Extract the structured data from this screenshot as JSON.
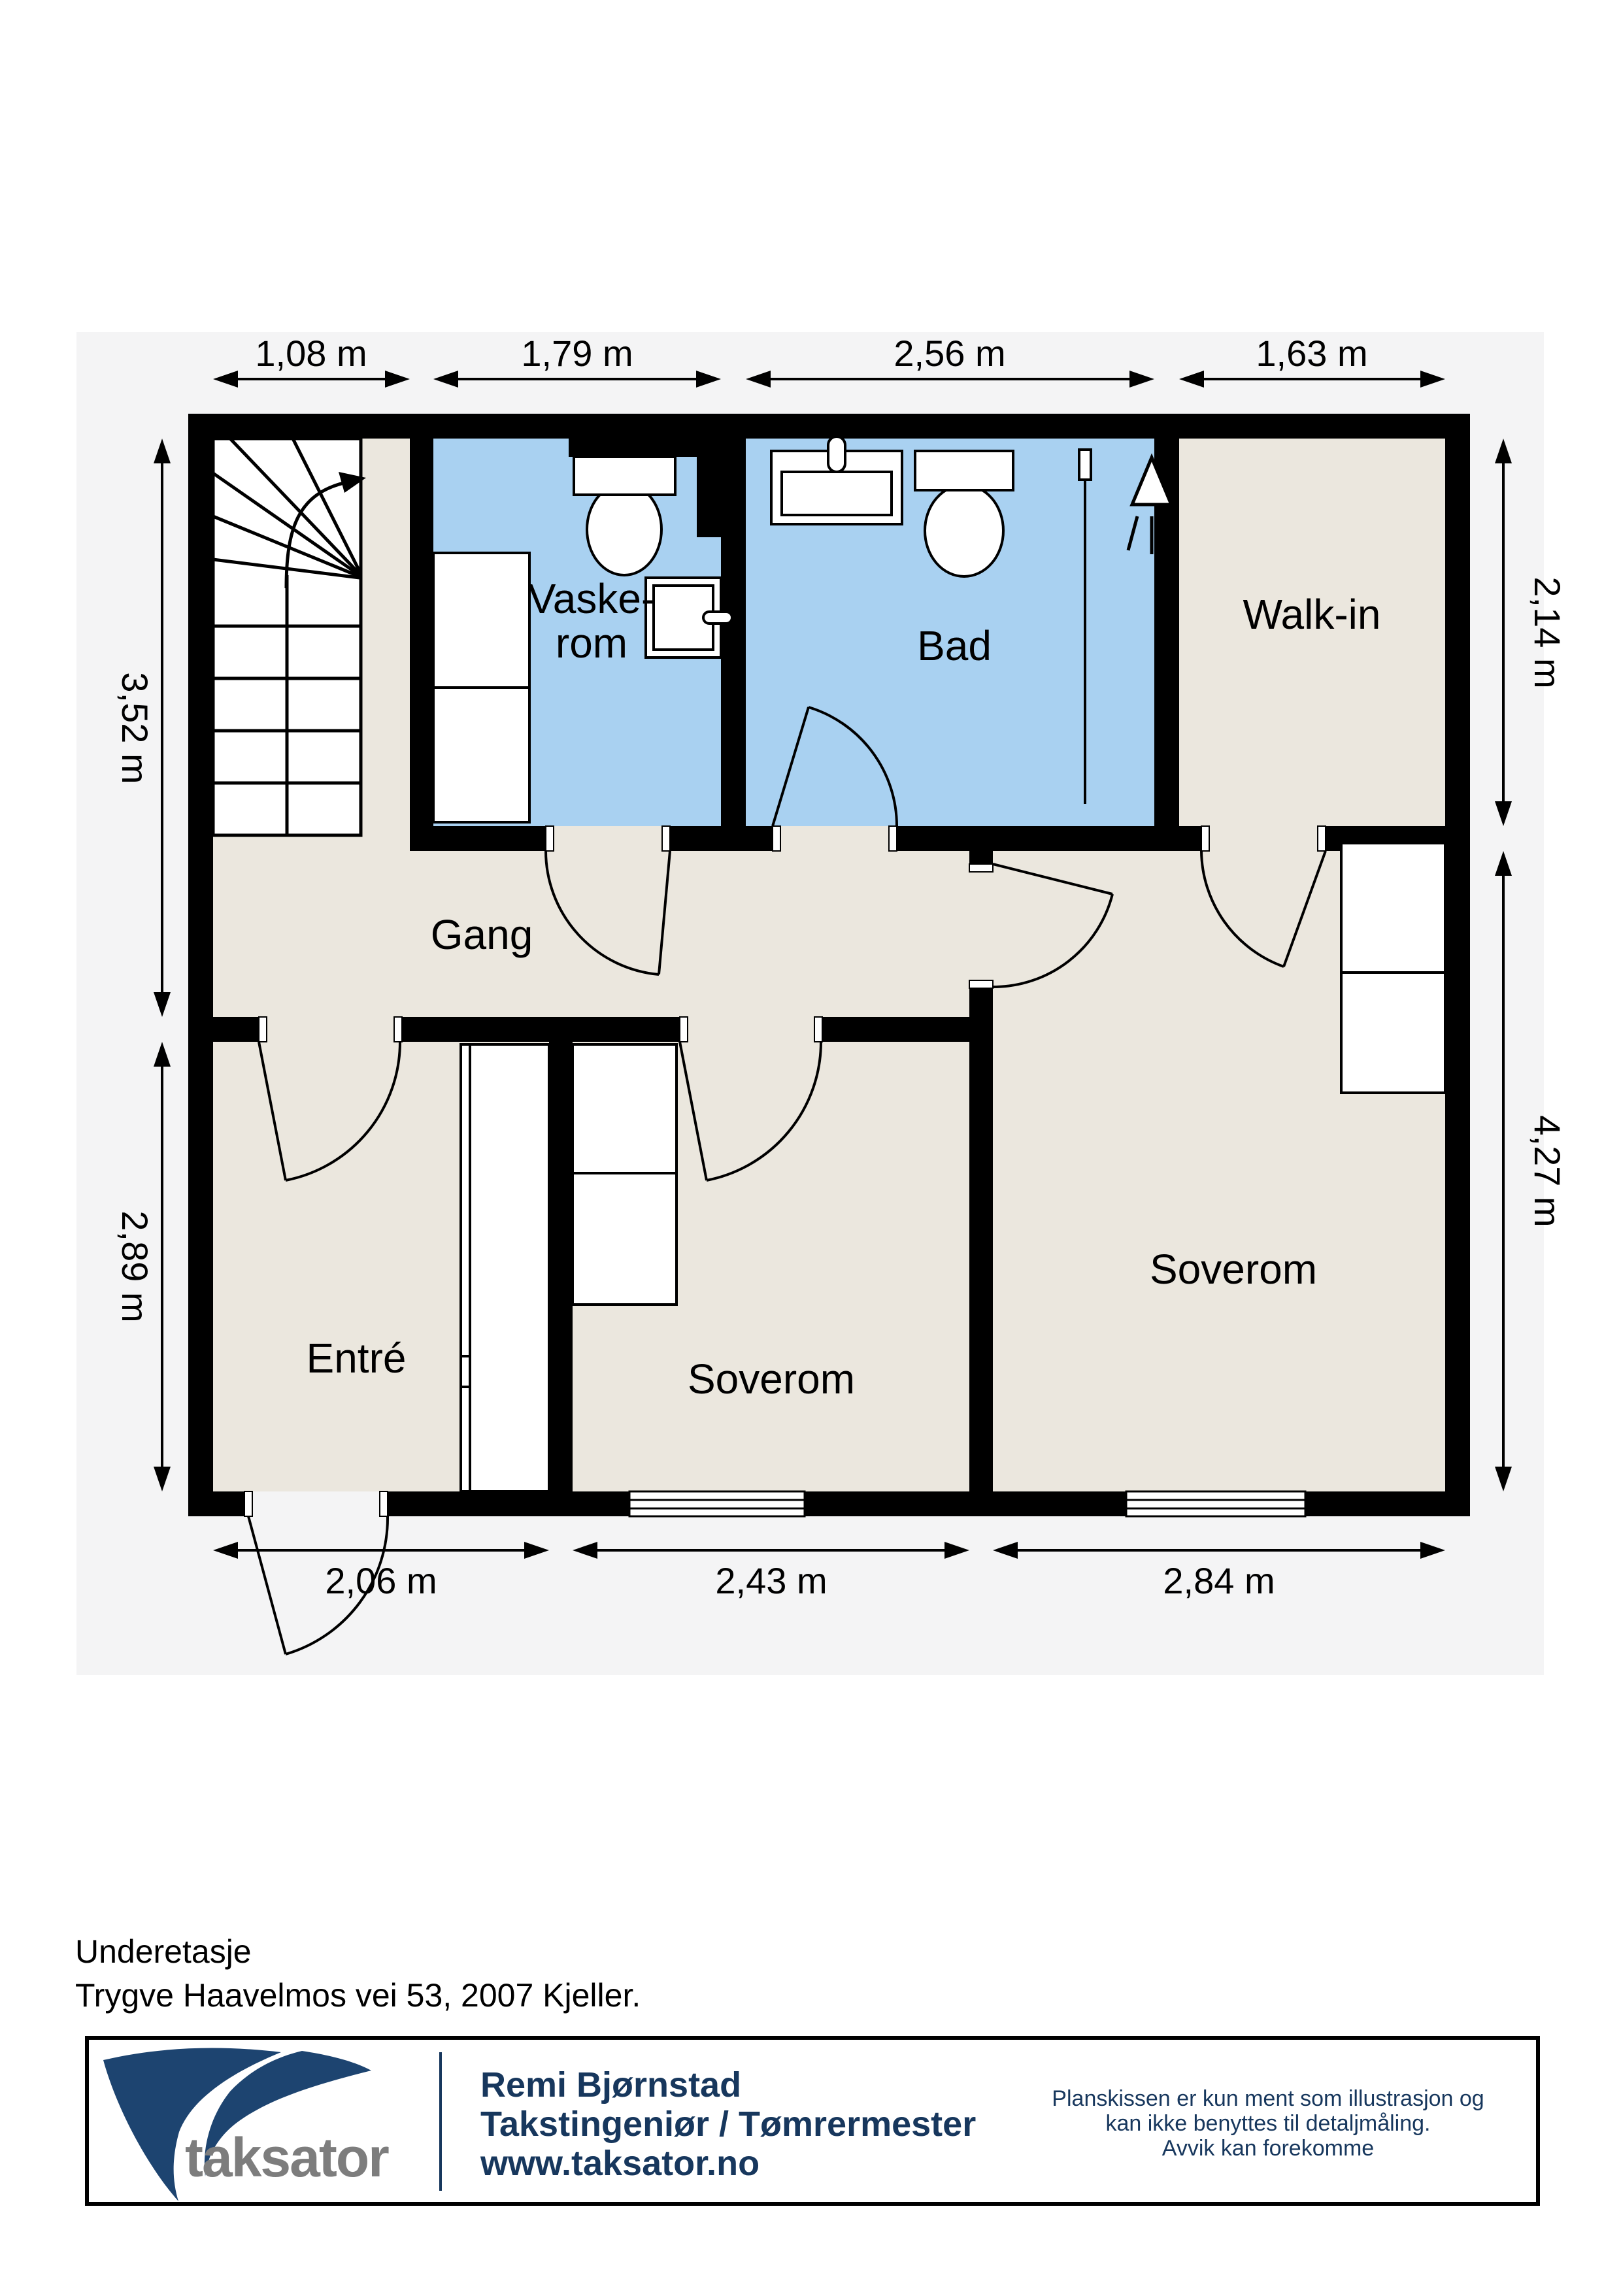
{
  "page": {
    "floor_label": "Underetasje",
    "address": "Trygve Haavelmos vei 53, 2007 Kjeller."
  },
  "plan": {
    "panel_color": "#f4f4f5",
    "floor_color": "#ebe7de",
    "wet_room_color": "#a9d1f1",
    "wall_color": "#000000",
    "rooms": {
      "vaskerom": {
        "line1": "Vaske-",
        "line2": "rom"
      },
      "bad": {
        "label": "Bad"
      },
      "walkin": {
        "label": "Walk-in"
      },
      "gang": {
        "label": "Gang"
      },
      "entre": {
        "label": "Entré"
      },
      "soverom_mid": {
        "label": "Soverom"
      },
      "soverom_right": {
        "label": "Soverom"
      }
    },
    "dimensions": {
      "top": [
        "1,08 m",
        "1,79 m",
        "2,56 m",
        "1,63 m"
      ],
      "left": [
        "3,52 m",
        "2,89 m"
      ],
      "right": [
        "2,14 m",
        "4,27 m"
      ],
      "bottom": [
        "2,06 m",
        "2,43 m",
        "2,84 m"
      ]
    }
  },
  "footer": {
    "logo_text": "taksator",
    "logo_color": "#1d4470",
    "logo_text_color": "#7d7d7d",
    "contact_name": "Remi Bjørnstad",
    "contact_title": "Takstingeniør / Tømrermester",
    "contact_web": "www.taksator.no",
    "disclaimer_line1": "Planskissen er kun ment som illustrasjon og",
    "disclaimer_line2": "kan ikke benyttes til detaljmåling.",
    "disclaimer_line3": "Avvik kan forekomme"
  }
}
